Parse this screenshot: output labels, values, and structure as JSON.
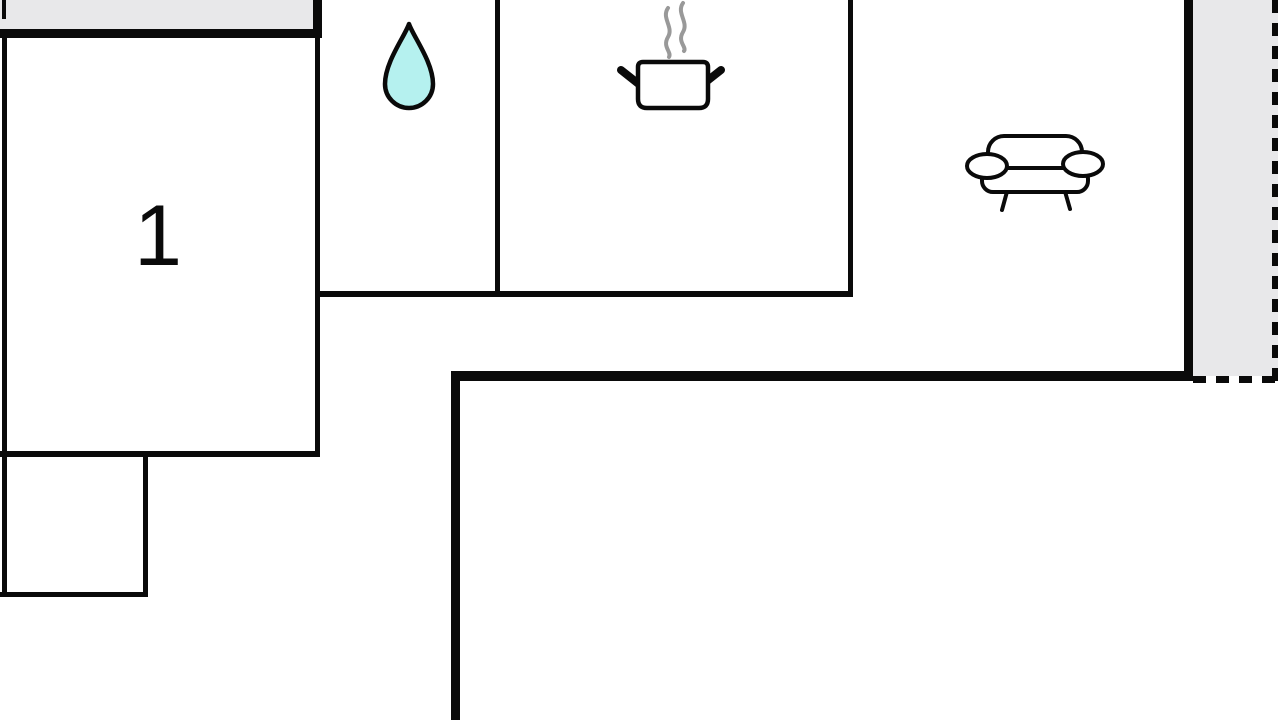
{
  "floorplan": {
    "rooms": {
      "bedroom": {
        "label": "1"
      }
    },
    "colors": {
      "wall": "#0a0a0a",
      "terrace_fill": "#e8e8ea",
      "water_drop_fill": "#b5f1ef",
      "steam": "#999999",
      "icon_outline": "#0a0a0a",
      "background": "#ffffff"
    },
    "icons": [
      {
        "name": "water-drop-icon"
      },
      {
        "name": "cooking-pot-icon"
      },
      {
        "name": "sofa-icon"
      }
    ]
  }
}
